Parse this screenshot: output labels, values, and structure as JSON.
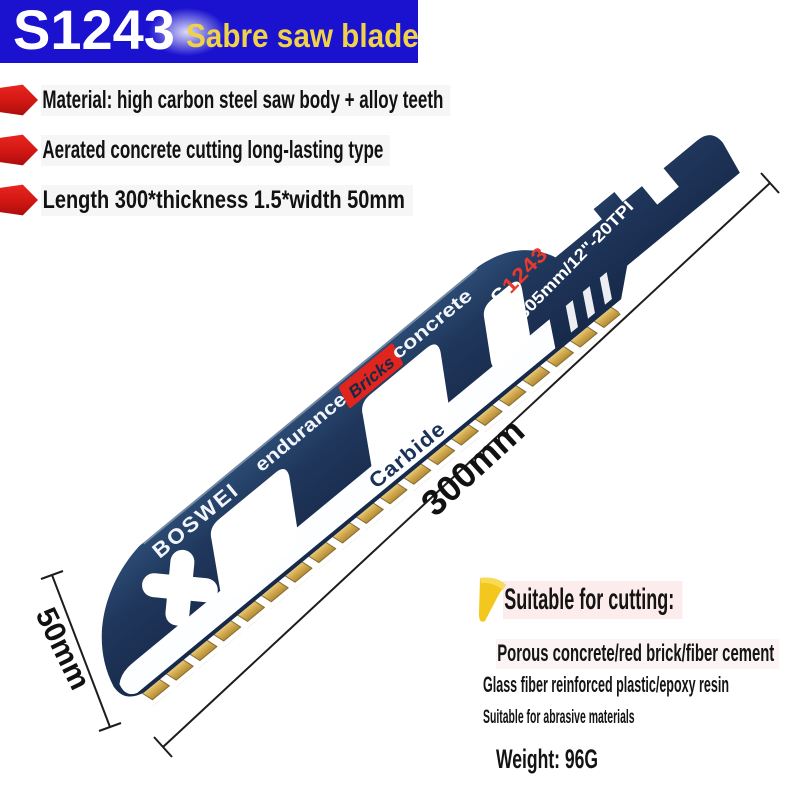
{
  "banner": {
    "model": "S1243",
    "subtitle": "Sabre saw blade"
  },
  "bullets": [
    {
      "text": "Material: high carbon steel saw body + alloy teeth"
    },
    {
      "text": "Aerated concrete cutting long-lasting type"
    },
    {
      "text": "Length 300*thickness 1.5*width 50mm"
    }
  ],
  "blade": {
    "brand": "BOSWEI",
    "back_label_1": "endurance",
    "back_label_2": "Bricks",
    "back_label_3": "concrete",
    "stripe_label": "Carbide",
    "model_prefix": "S",
    "model_red": "1243",
    "model_suffix": "HM-CT",
    "spec": "305mm/12\"-20TPI"
  },
  "dimensions": {
    "length_label": "300mm",
    "width_label": "50mm"
  },
  "suitable": {
    "heading": "Suitable for cutting:",
    "items": [
      "Porous concrete/red brick/fiber cement",
      "Glass fiber reinforced plastic/epoxy resin",
      "Suitable for abrasive materials"
    ],
    "weight": "Weight: 96G"
  },
  "colors": {
    "banner_blue": "#1a12cf",
    "accent_red": "#d9201d",
    "accent_yellow": "#f3c71d",
    "blade_navy": "#1e3457",
    "teeth_gold": "#d3ac52"
  }
}
